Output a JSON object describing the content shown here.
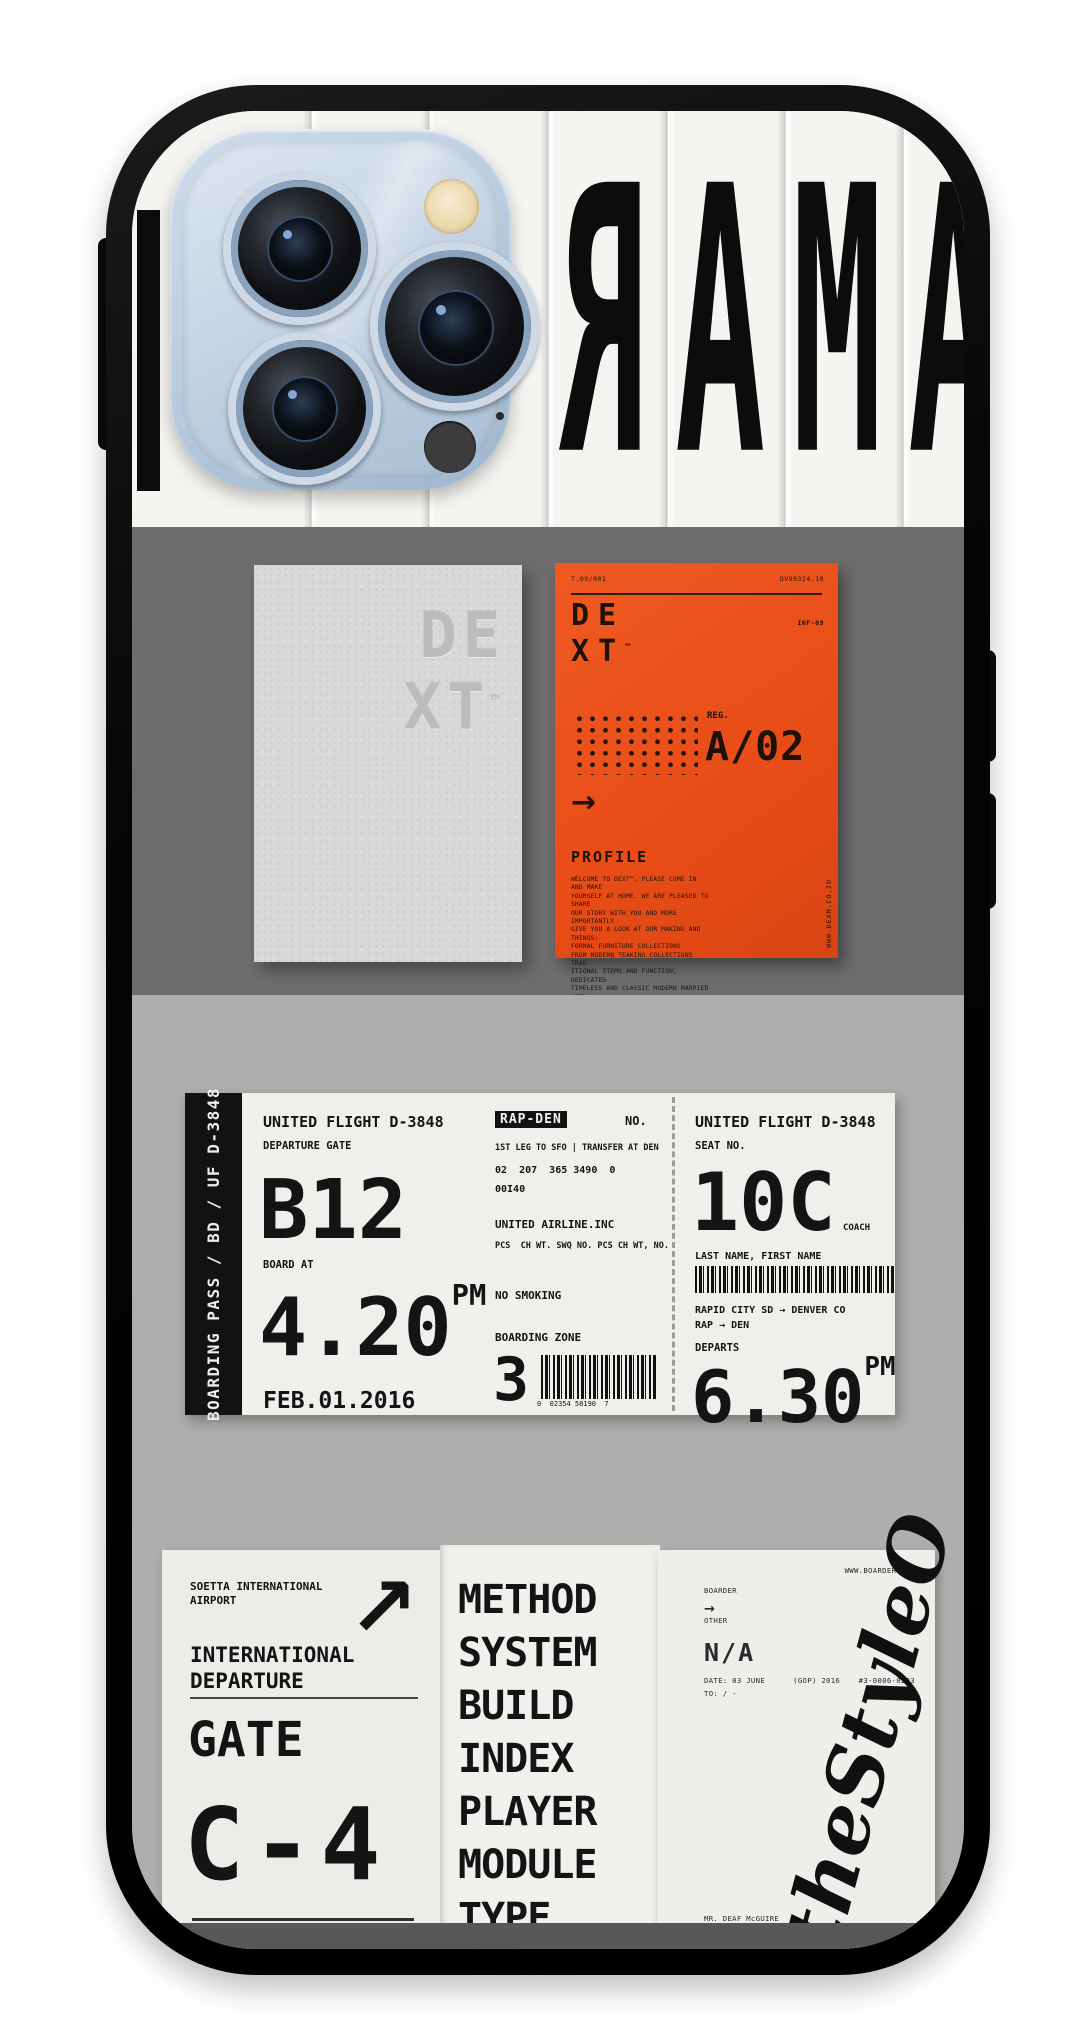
{
  "brand": {
    "watermark": "theStyleO"
  },
  "colors": {
    "case": "#0a0a0a",
    "orange": "#e84c17",
    "band_dark": "#6d6d6d",
    "band_light": "#aeaeac",
    "slat": "#f4f4f1"
  },
  "top_art": {
    "letters": "RAMA"
  },
  "paper_card": {
    "line1": "DE",
    "line2": "XT",
    "tm": "™"
  },
  "orange_card": {
    "serial_left": "T.09/001",
    "serial_right": "DV90324.10",
    "inf": "INF-09",
    "brand_line1": "DE",
    "brand_line2": "XT",
    "tm": "™",
    "reg_label": "REG.",
    "reg_value": "A/02",
    "arrow": "→",
    "profile_label": "PROFILE",
    "profile_lines": [
      "WELCOME TO DEXT™. PLEASE COME IN AND MAKE",
      "YOURSELF AT HOME. WE ARE PLEASED TO SHARE",
      "OUR STORY WITH YOU AND MORE IMPORTANTLY",
      "GIVE YOU A LOOK AT OUR MAKING AND THINGS:",
      "FORMAL FURNITURE COLLECTIONS",
      "FROM MODERN TEAKING COLLECTIONS TRAD-",
      "ITIONAL ITEMS AND FUNCTION, DEDICATED",
      "TIMELESS AND CLASSIC MODERN MARRIED WITH",
      "A MODERN ART OF THINKING"
    ],
    "website": "WWW.DEXM.CO.ID"
  },
  "boarding_pass": {
    "sidebar": "BOARDING PASS / BD / UF D-3848",
    "left": {
      "flight": "UNITED FLIGHT D-3848",
      "gate_label": "DEPARTURE GATE",
      "gate": "B12",
      "board_label": "BOARD AT",
      "board_time": "4.20",
      "board_ampm": "PM",
      "date": "FEB.01.2016"
    },
    "middle": {
      "route_chip": "RAP-DEN",
      "no_label": "NO.",
      "leg": "1ST LEG TO SFO | TRANSFER AT DEN",
      "numbers": "02  207  365 3490  0",
      "code": "00I40",
      "airline": "UNITED AIRLINE.INC",
      "pcs": "PCS  CH WT. SWQ NO. PCS CH WT, NO.",
      "smoking": "NO SMOKING",
      "zone_label": "BOARDING ZONE",
      "zone": "3",
      "barcode_digits": "0  02354 58190  7"
    },
    "right": {
      "flight": "UNITED FLIGHT D-3848",
      "seat_label": "SEAT NO.",
      "seat": "10C",
      "cabin": "COACH",
      "name_label": "LAST NAME, FIRST NAME",
      "route_full": "RAPID CITY SD → DENVER CO",
      "route_short": "RAP → DEN",
      "departs_label": "DEPARTS",
      "depart_time": "6.30",
      "depart_ampm": "PM"
    }
  },
  "gate_card": {
    "airport_line1": "SOETTA INTERNATIONAL",
    "airport_line2": "AIRPORT",
    "arrow": "↗",
    "dep_line1": "INTERNATIONAL",
    "dep_line2": "DEPARTURE",
    "gate_label": "GATE",
    "gate": "C-4"
  },
  "spec_list": {
    "items": [
      "METHOD",
      "SYSTEM",
      "BUILD",
      "INDEX",
      "PLAYER",
      "MODULE",
      "TYPE"
    ]
  },
  "ship_card": {
    "header_line1": "BOARDER",
    "header_line2": "OTHER",
    "website": "WWW.BOARDER.COM",
    "arrow": "→",
    "na": "N/A",
    "date_line": "DATE: 03 JUNE      (GOP) 2016",
    "ref": "#3-0006-0203",
    "to_line": "TO: / -",
    "addr_line1": "MR. DEAF McGUIRE",
    "addr_line2": "2042 WESTERN ROAD",
    "addr_line3": "HOLYWOOD, CA",
    "addr_line4": "WEST"
  }
}
